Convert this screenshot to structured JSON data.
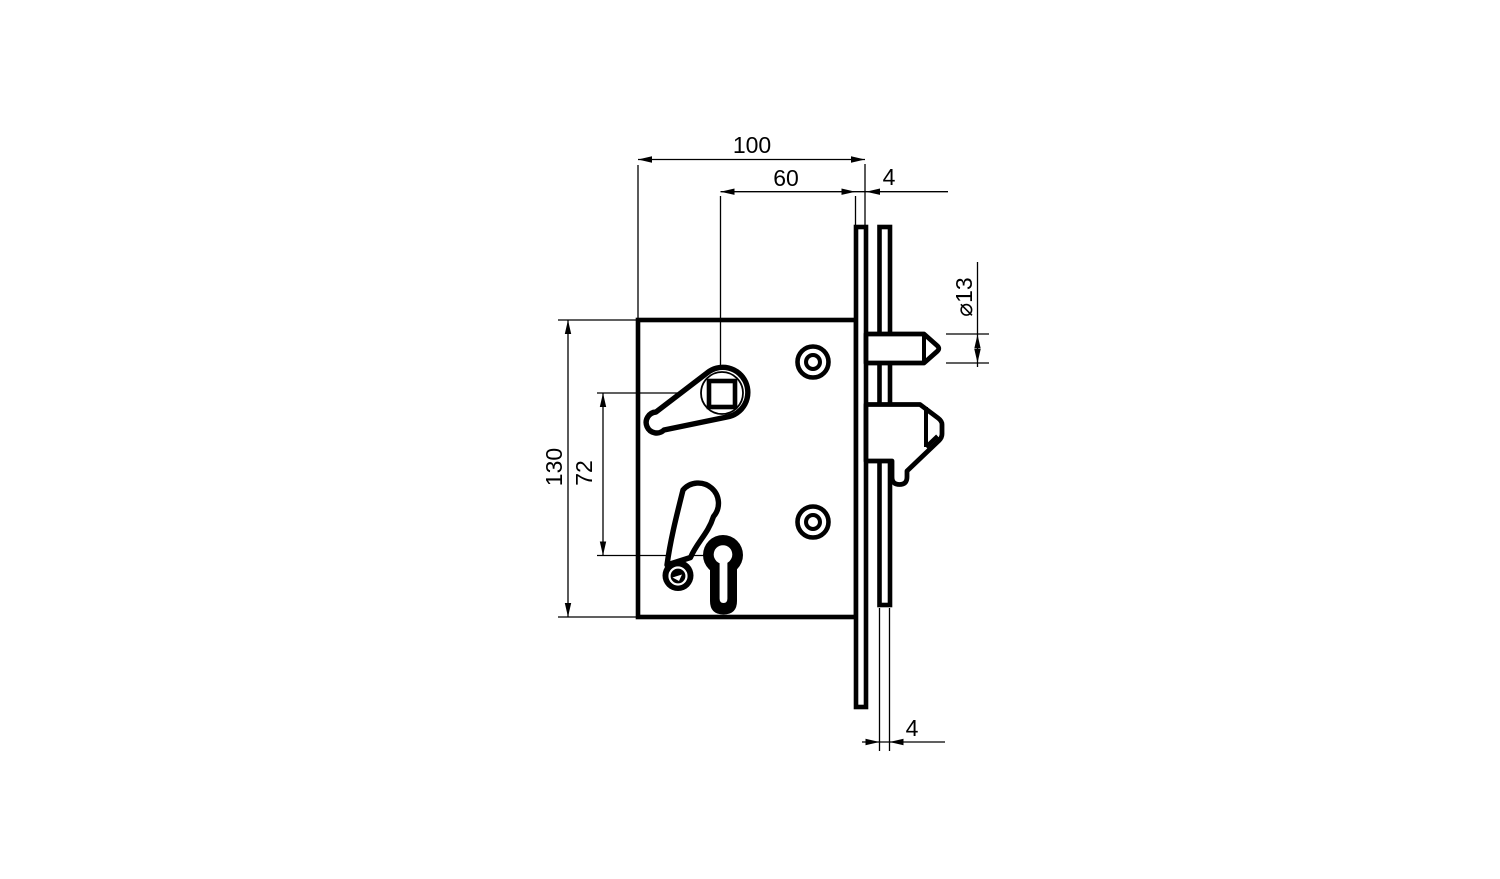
{
  "drawing": {
    "type": "technical-drawing",
    "subject": "mortise-hook-lock-side-view",
    "colors": {
      "line": "#000000",
      "background": "#ffffff"
    },
    "dimensions": {
      "top_width": "100",
      "backset": "60",
      "faceplate_thickness_top": "4",
      "latch_diameter": "⌀13",
      "body_height": "130",
      "spindle_to_cylinder": "72",
      "faceplate_thickness_bottom": "4"
    }
  }
}
